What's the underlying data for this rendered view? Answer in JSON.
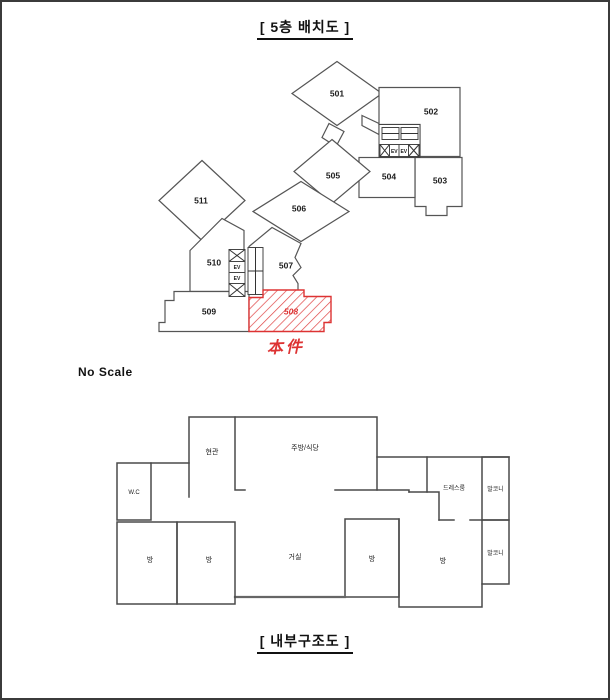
{
  "page": {
    "title_top": "[ 5층 배치도 ]",
    "no_scale": "No Scale",
    "title_bottom": "[ 내부구조도 ]"
  },
  "site_plan": {
    "elevator_label": "EV",
    "units": [
      {
        "id": "501"
      },
      {
        "id": "502"
      },
      {
        "id": "503"
      },
      {
        "id": "504"
      },
      {
        "id": "505"
      },
      {
        "id": "506"
      },
      {
        "id": "507"
      },
      {
        "id": "509"
      },
      {
        "id": "510"
      },
      {
        "id": "511"
      }
    ],
    "subject_unit": {
      "id": "508",
      "note": "本件",
      "color": "#dd3333"
    }
  },
  "floor_plan": {
    "rooms": [
      {
        "name": "현관"
      },
      {
        "name": "주방/식당"
      },
      {
        "name": "W.C"
      },
      {
        "name": "방"
      },
      {
        "name": "방"
      },
      {
        "name": "거실"
      },
      {
        "name": "방"
      },
      {
        "name": "방"
      },
      {
        "name": "드레스룸"
      },
      {
        "name": "발코니"
      },
      {
        "name": "발코니"
      }
    ]
  }
}
